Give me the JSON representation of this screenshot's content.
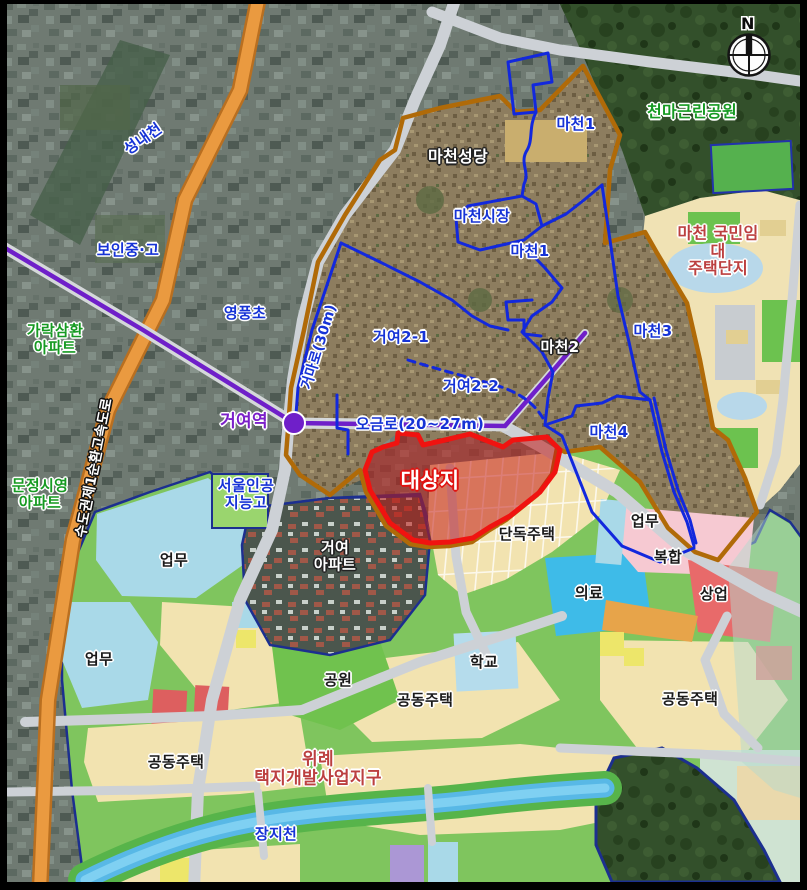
{
  "map": {
    "compass_n": "N",
    "colors": {
      "highway_orange": "#ec9c40",
      "subway_purple": "#6f1fc9",
      "district_boundary_brown": "#b06a08",
      "subdistrict_boundary_blue": "#1228dd",
      "target_site_red": "#f01310",
      "landuse_residential_beige": "#f2e3b0",
      "landuse_park_green": "#7cc457",
      "landuse_business_blue": "#a9d9e8",
      "landuse_medical_blue": "#3ebbe8",
      "landuse_mixed_pink": "#f6c9d2",
      "landuse_commercial_red": "#e86a6a",
      "river_blue": "#5ab9e8"
    },
    "labels": [
      {
        "name": "label-seongnaecheon",
        "text": "성내천",
        "x": 143,
        "y": 139,
        "cls": "lbl-blue",
        "size": 15,
        "rot": -35
      },
      {
        "name": "label-boin-middle-high",
        "text": "보인중·고",
        "x": 128,
        "y": 250,
        "cls": "lbl-blue",
        "size": 15
      },
      {
        "name": "label-yeongpung-elem",
        "text": "영풍초",
        "x": 245,
        "y": 313,
        "cls": "lbl-blue",
        "size": 15
      },
      {
        "name": "label-garak-samhwan-apt",
        "text": "가락삼환\n아파트",
        "x": 55,
        "y": 339,
        "cls": "lbl-green",
        "size": 15
      },
      {
        "name": "label-munjeong-siyeong-apt",
        "text": "문정시영\n아파트",
        "x": 40,
        "y": 494,
        "cls": "lbl-green",
        "size": 15
      },
      {
        "name": "label-sudogwon-highway",
        "text": "수도권제1순환고속도로",
        "x": 95,
        "y": 468,
        "cls": "lbl-roadwhite",
        "size": 14,
        "rot": -79
      },
      {
        "name": "label-geoyeo-station",
        "text": "거여역",
        "x": 244,
        "y": 422,
        "cls": "lbl-purple",
        "size": 17
      },
      {
        "name": "label-ogeum-ro",
        "text": "오금로(20~27m)",
        "x": 420,
        "y": 424,
        "cls": "lbl-blue",
        "size": 15
      },
      {
        "name": "label-geoma-ro",
        "text": "거마로(30m)",
        "x": 320,
        "y": 347,
        "cls": "lbl-blue",
        "size": 14,
        "rot": -73
      },
      {
        "name": "label-macheon-cathedral",
        "text": "마천성당",
        "x": 458,
        "y": 157,
        "cls": "lbl-white",
        "size": 16
      },
      {
        "name": "label-macheon-market",
        "text": "마천시장",
        "x": 482,
        "y": 216,
        "cls": "lbl-blue",
        "size": 15
      },
      {
        "name": "label-macheon1-north",
        "text": "마천1",
        "x": 576,
        "y": 124,
        "cls": "lbl-blue",
        "size": 15
      },
      {
        "name": "label-macheon1-central",
        "text": "마천1",
        "x": 530,
        "y": 251,
        "cls": "lbl-blue",
        "size": 15
      },
      {
        "name": "label-cheonma-park",
        "text": "천마근린공원",
        "x": 692,
        "y": 112,
        "cls": "lbl-green",
        "size": 16
      },
      {
        "name": "label-macheon-rental",
        "text": "마천 국민임대\n주택단지",
        "x": 718,
        "y": 251,
        "cls": "lbl-darkred",
        "size": 16
      },
      {
        "name": "label-macheon3",
        "text": "마천3",
        "x": 653,
        "y": 331,
        "cls": "lbl-blue",
        "size": 15
      },
      {
        "name": "label-macheon2",
        "text": "마천2",
        "x": 560,
        "y": 347,
        "cls": "lbl-white",
        "size": 15
      },
      {
        "name": "label-macheon4",
        "text": "마천4",
        "x": 609,
        "y": 432,
        "cls": "lbl-blue",
        "size": 15
      },
      {
        "name": "label-geoyeo2-1",
        "text": "거여2-1",
        "x": 401,
        "y": 337,
        "cls": "lbl-blue",
        "size": 15
      },
      {
        "name": "label-geoyeo2-2",
        "text": "거여2-2",
        "x": 471,
        "y": 386,
        "cls": "lbl-blue",
        "size": 15
      },
      {
        "name": "label-seoul-ai-high",
        "text": "서울인공\n지능고",
        "x": 246,
        "y": 494,
        "cls": "lbl-blue",
        "size": 15
      },
      {
        "name": "label-target-site",
        "text": "대상지",
        "x": 430,
        "y": 481,
        "cls": "lbl-redout",
        "size": 21
      },
      {
        "name": "label-geoyeo-apt",
        "text": "거여\n아파트",
        "x": 335,
        "y": 556,
        "cls": "lbl-white",
        "size": 15
      },
      {
        "name": "label-dandok-jutaek",
        "text": "단독주택",
        "x": 527,
        "y": 534,
        "cls": "lbl-black",
        "size": 15
      },
      {
        "name": "label-eopmu-ne",
        "text": "업무",
        "x": 645,
        "y": 521,
        "cls": "lbl-black",
        "size": 15
      },
      {
        "name": "label-bokhap",
        "text": "복합",
        "x": 668,
        "y": 557,
        "cls": "lbl-black",
        "size": 15
      },
      {
        "name": "label-uiryo",
        "text": "의료",
        "x": 589,
        "y": 593,
        "cls": "lbl-black",
        "size": 15
      },
      {
        "name": "label-sangeop",
        "text": "상업",
        "x": 714,
        "y": 594,
        "cls": "lbl-black",
        "size": 15
      },
      {
        "name": "label-eopmu-west-1",
        "text": "업무",
        "x": 174,
        "y": 560,
        "cls": "lbl-black",
        "size": 15
      },
      {
        "name": "label-eopmu-west-2",
        "text": "업무",
        "x": 99,
        "y": 659,
        "cls": "lbl-black",
        "size": 15
      },
      {
        "name": "label-gongwon",
        "text": "공원",
        "x": 338,
        "y": 680,
        "cls": "lbl-black",
        "size": 15
      },
      {
        "name": "label-hakgyo",
        "text": "학교",
        "x": 484,
        "y": 662,
        "cls": "lbl-black",
        "size": 15
      },
      {
        "name": "label-gongdong-center",
        "text": "공동주택",
        "x": 425,
        "y": 700,
        "cls": "lbl-black",
        "size": 15
      },
      {
        "name": "label-gongdong-east",
        "text": "공동주택",
        "x": 690,
        "y": 699,
        "cls": "lbl-black",
        "size": 15
      },
      {
        "name": "label-gongdong-west",
        "text": "공동주택",
        "x": 176,
        "y": 762,
        "cls": "lbl-black",
        "size": 15
      },
      {
        "name": "label-wirye-district",
        "text": "위례\n택지개발사업지구",
        "x": 318,
        "y": 769,
        "cls": "lbl-darkred",
        "size": 17
      },
      {
        "name": "label-jangjicheon",
        "text": "장지천",
        "x": 276,
        "y": 834,
        "cls": "lbl-blue",
        "size": 15
      }
    ]
  }
}
